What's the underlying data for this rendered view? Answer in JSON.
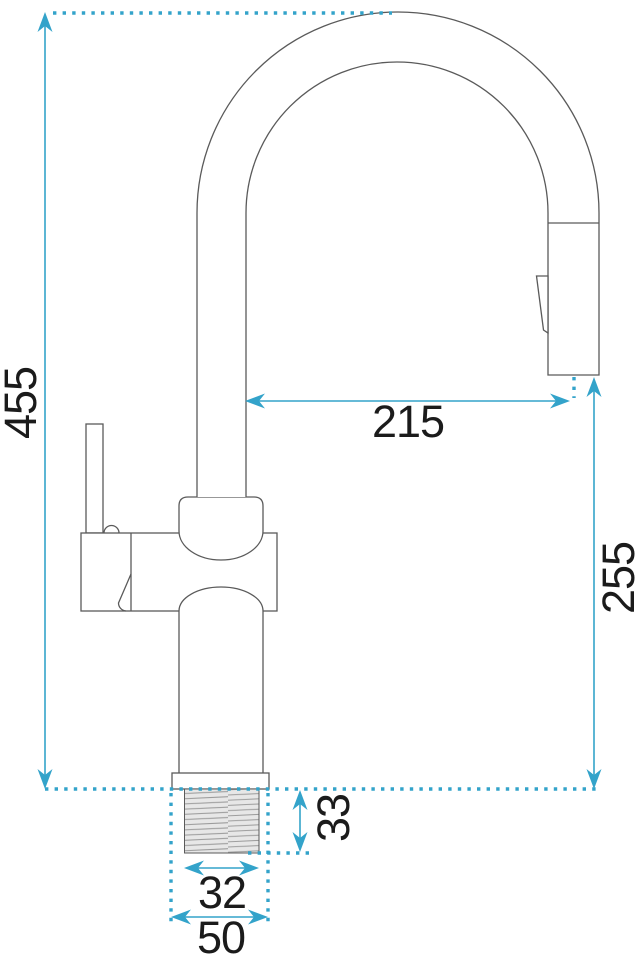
{
  "diagram": {
    "kind": "technical-dimension-drawing",
    "subject": "kitchen faucet with pull-out spray head, side view",
    "colors": {
      "accent": "#33a3ca",
      "outline": "#5a5a5a",
      "label": "#1b1b1b",
      "thread_fill": "#e7e7e7"
    },
    "dimensions": [
      {
        "id": "overall-height",
        "value": "455",
        "orientation": "vertical",
        "measures": "total faucet height from base plane to top of spout arc"
      },
      {
        "id": "spout-reach",
        "value": "215",
        "orientation": "horizontal",
        "measures": "horizontal reach from riser pipe to outlet center"
      },
      {
        "id": "outlet-clearance",
        "value": "255",
        "orientation": "vertical",
        "measures": "height from base plane to spray outlet"
      },
      {
        "id": "thread-length",
        "value": "33",
        "orientation": "vertical",
        "measures": "threaded shank length below base plane"
      },
      {
        "id": "thread-diameter",
        "value": "32",
        "orientation": "horizontal",
        "measures": "threaded shank diameter"
      },
      {
        "id": "hole-diameter",
        "value": "50",
        "orientation": "horizontal",
        "measures": "required mounting hole / base diameter"
      }
    ]
  }
}
